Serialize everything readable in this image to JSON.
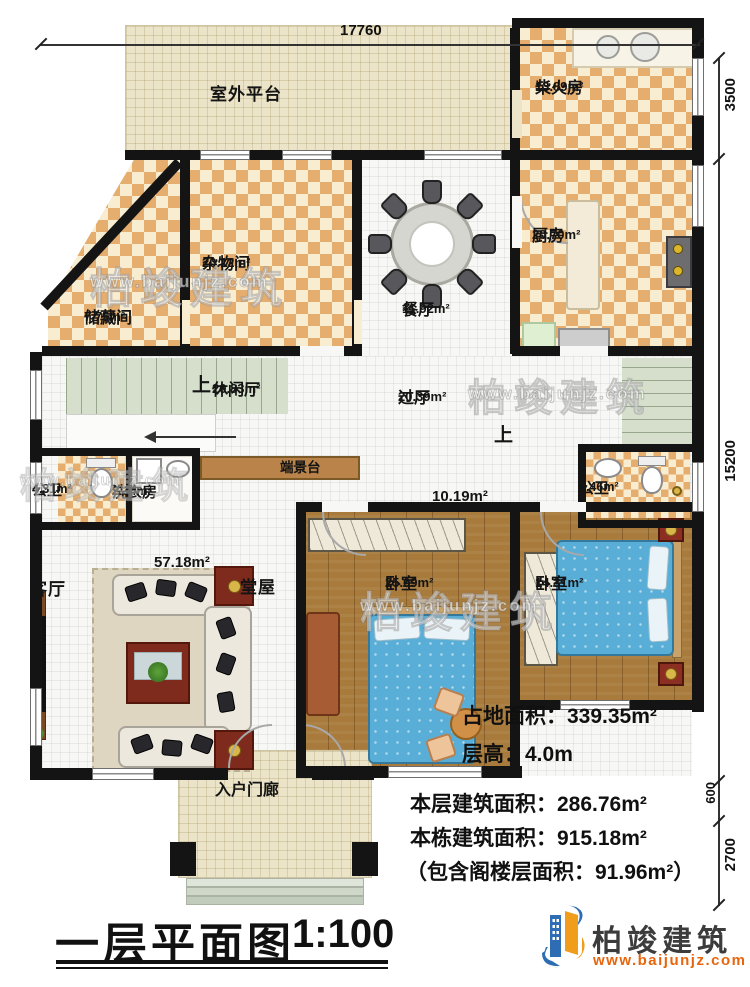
{
  "meta": {
    "title_main": "一层平面图",
    "title_scale": "1:100"
  },
  "logo": {
    "name": "柏竣建筑",
    "url": "www.baijunjz.com"
  },
  "watermark": {
    "name": "柏竣建筑",
    "url": "www.baijunjz.com"
  },
  "dims": {
    "top": "17760",
    "right_top": "3500",
    "right_mid": "15200",
    "right_small": "600",
    "right_bottom": "2700"
  },
  "stairs": {
    "up": "上"
  },
  "rooms": {
    "platform": {
      "name": "室外平台"
    },
    "firewood": {
      "name": "柴火房",
      "area": "13.89m²"
    },
    "kitchen": {
      "name": "厨房",
      "area": "20.70m²"
    },
    "sundry": {
      "name": "杂物间",
      "area": "20.12m²"
    },
    "storage": {
      "name": "储藏间",
      "area": "7.75m²"
    },
    "dining": {
      "name": "餐厅",
      "area": "11.92m²"
    },
    "leisure": {
      "name": "休闲厅",
      "area": "20.83m²"
    },
    "hallway": {
      "name": "过厅",
      "area": "20.39m²"
    },
    "console": {
      "name": "端景台"
    },
    "bath_left": {
      "name": "公卫",
      "area": "4.31m²"
    },
    "laundry": {
      "name": "洗衣房",
      "area": "2.34m²"
    },
    "bath_right": {
      "name": "公卫",
      "area": "4.46m²"
    },
    "corridor": {
      "area": "10.19m²"
    },
    "hall": {
      "name": "堂屋",
      "area": "57.18m²"
    },
    "living": {
      "name": "客厅"
    },
    "bedroom1": {
      "name": "卧室",
      "area": "25.09m²"
    },
    "bedroom2": {
      "name": "卧室",
      "area": "14.31m²"
    },
    "porch": {
      "name": "入户门廊"
    }
  },
  "info": {
    "footprint": "占地面积：339.35m²",
    "floor_height": "层高：4.0m",
    "floor_area": "本层建筑面积：286.76m²",
    "building_area": "本栋建筑面积：915.18m²",
    "attic_note": "（包含阁楼层面积：91.96m²）"
  }
}
